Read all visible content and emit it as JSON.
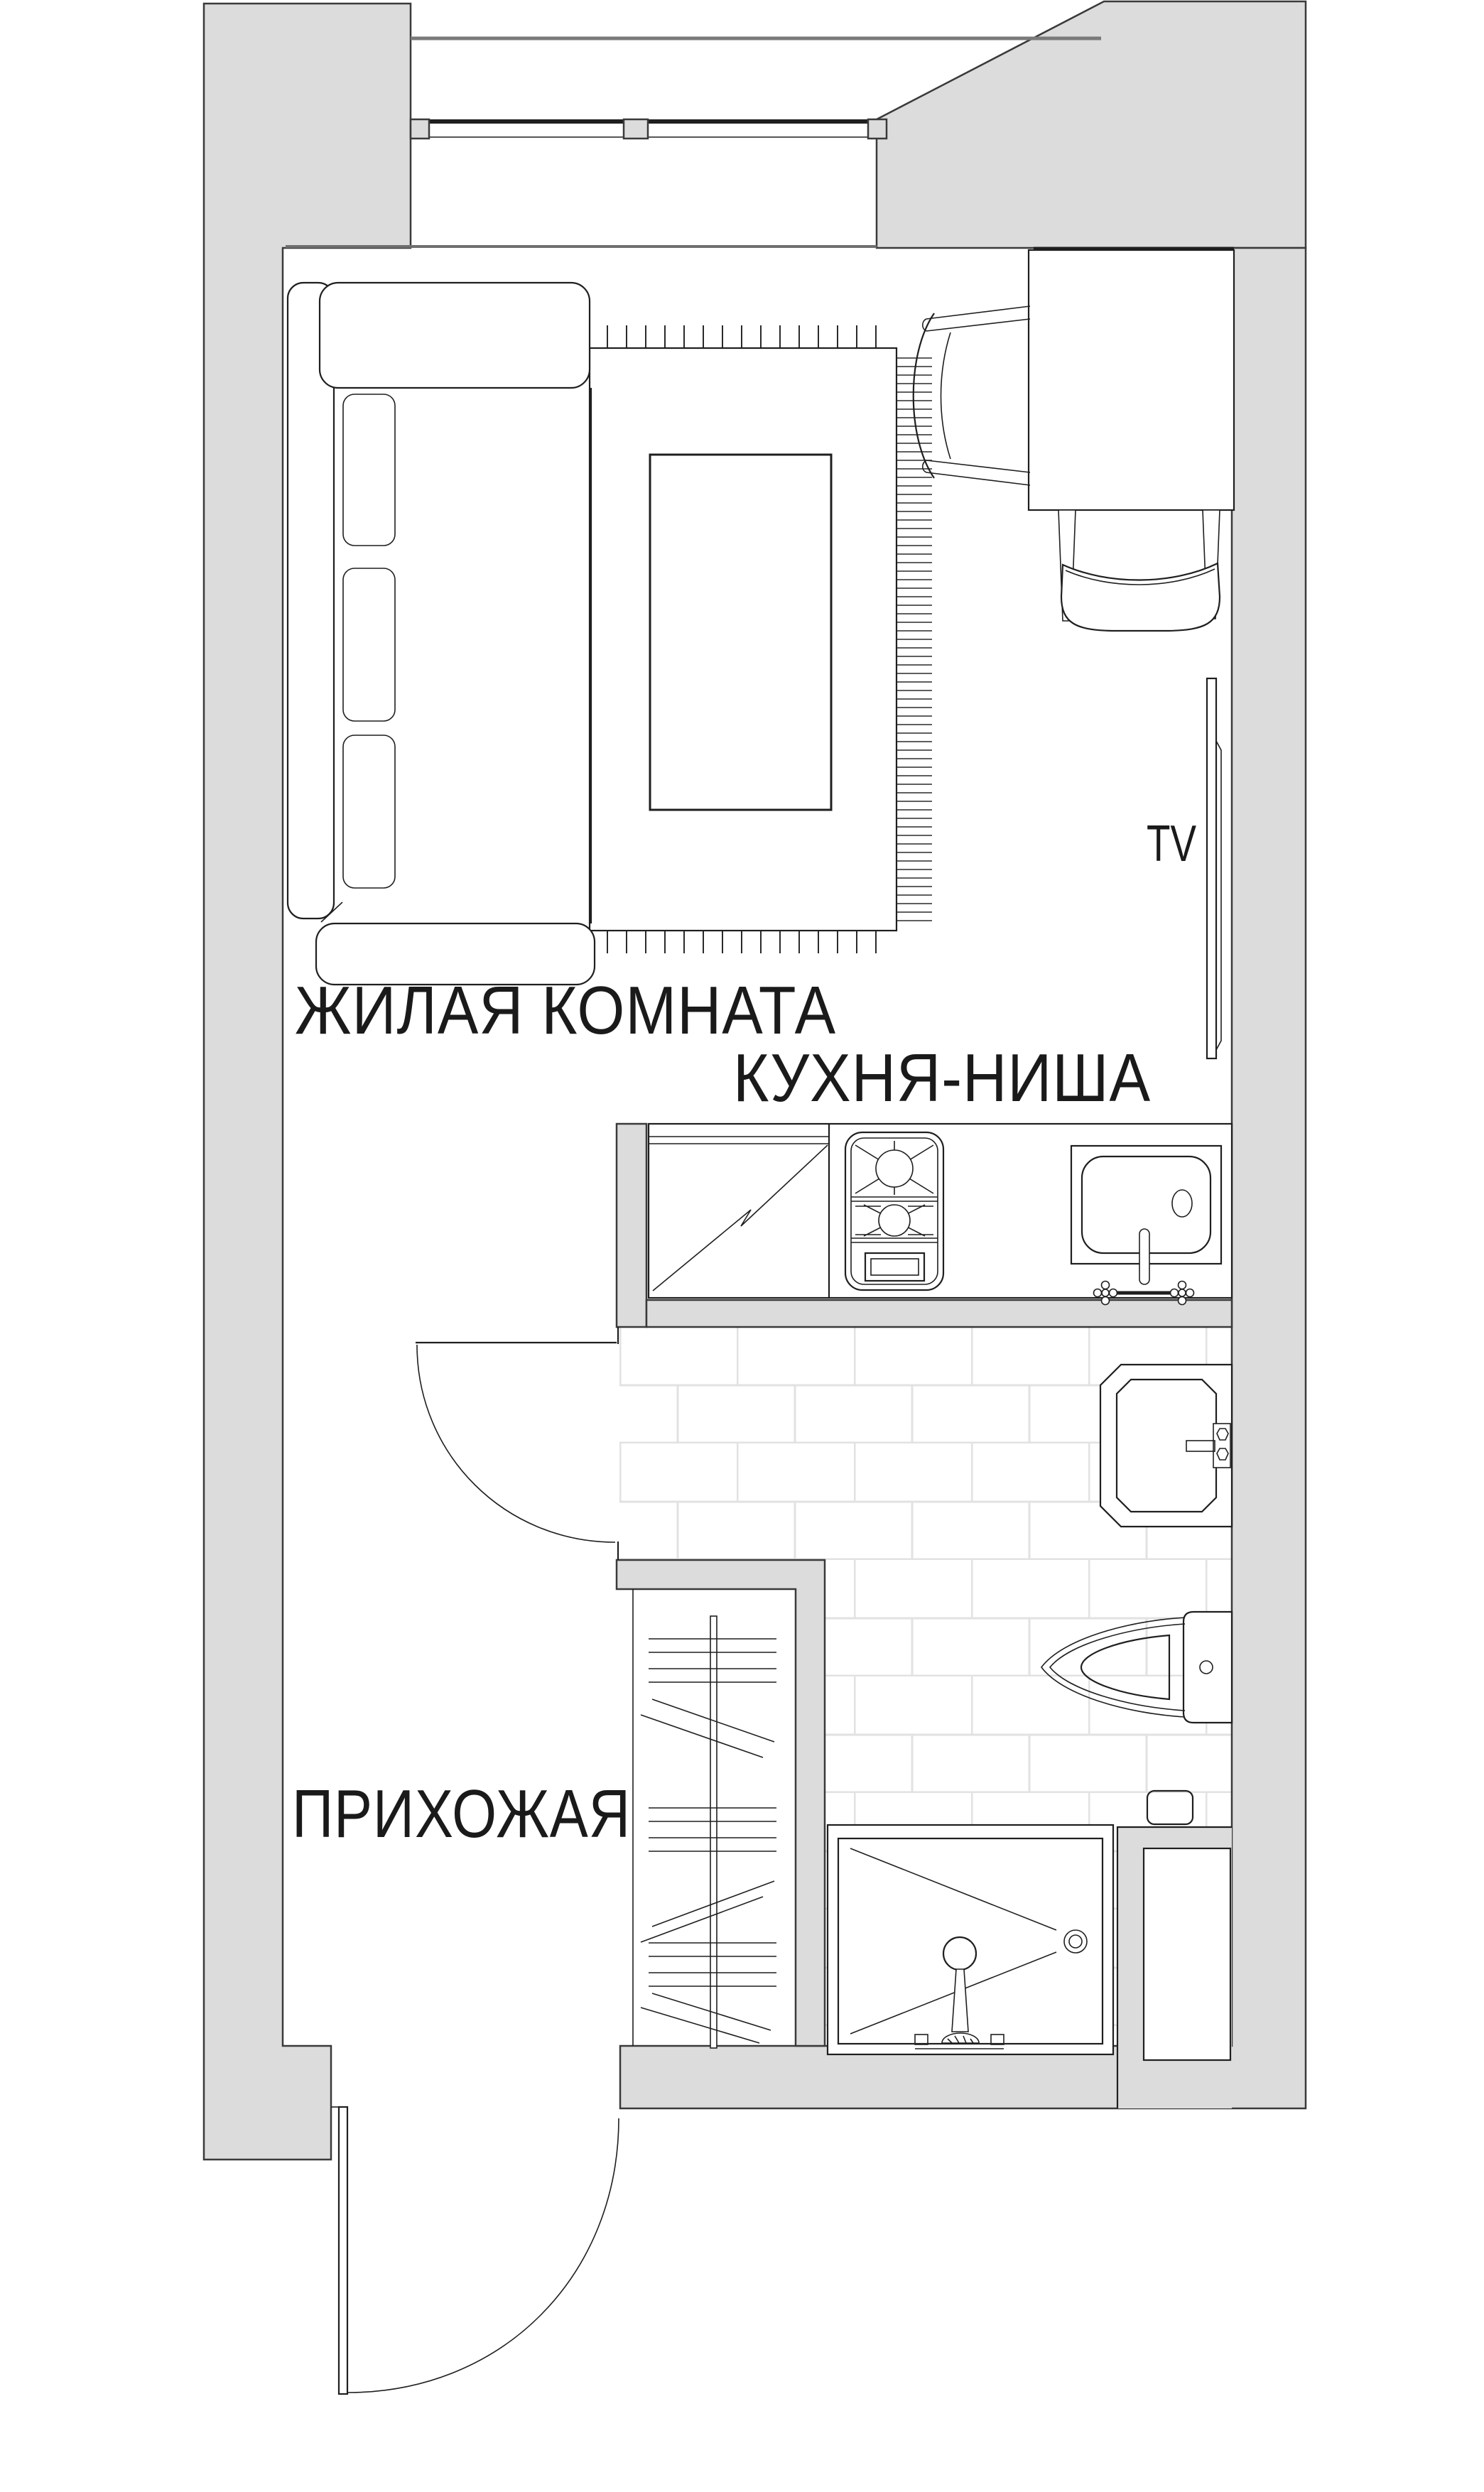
{
  "labels": {
    "living_room": "ЖИЛАЯ КОМНАТА",
    "kitchen_niche": "КУХНЯ-НИША",
    "hallway": "ПРИХОЖАЯ",
    "tv": "TV"
  },
  "colors": {
    "wall_fill": "#dcdcdc",
    "wall_outline": "#3a3a3a",
    "furniture_line": "#1f1f1f",
    "tile_grout": "#e2e2e2",
    "balcony_edge_line": "#7a7a7a",
    "text": "#1a1a1a"
  }
}
